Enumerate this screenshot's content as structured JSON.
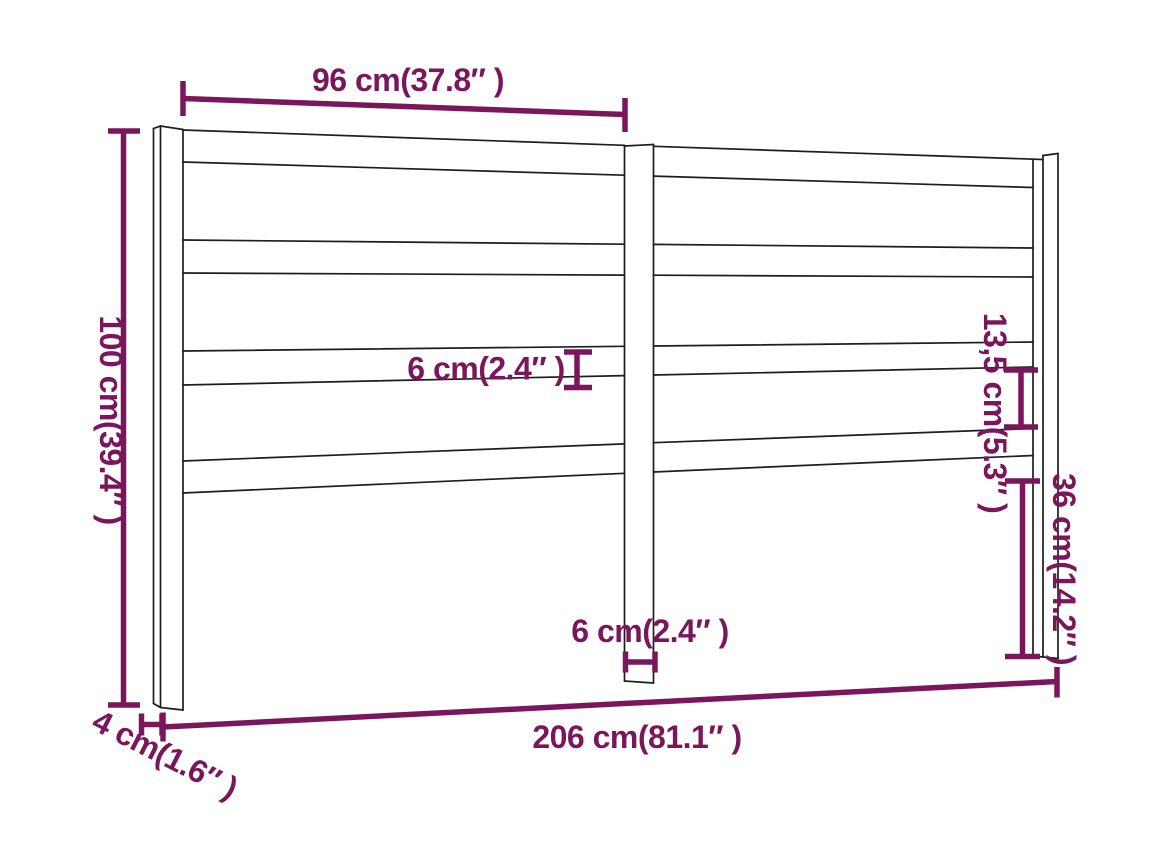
{
  "diagram": {
    "colors": {
      "dimension_accent": "#7a175c",
      "outline": "#1d1d1d",
      "background": "#ffffff"
    },
    "labels": {
      "top_width": "96 cm(37.8″ )",
      "total_height": "100 cm(39.4″ )",
      "slat_thickness": "6 cm(2.4″ )",
      "slat_gap": "13,5 cm(5.3″ )",
      "leg_below_panel": "36 cm(14.2″ )",
      "center_post_width": "6 cm(2.4″ )",
      "total_width": "206 cm(81.1″ )",
      "post_depth": "4 cm(1.6″ )"
    }
  }
}
